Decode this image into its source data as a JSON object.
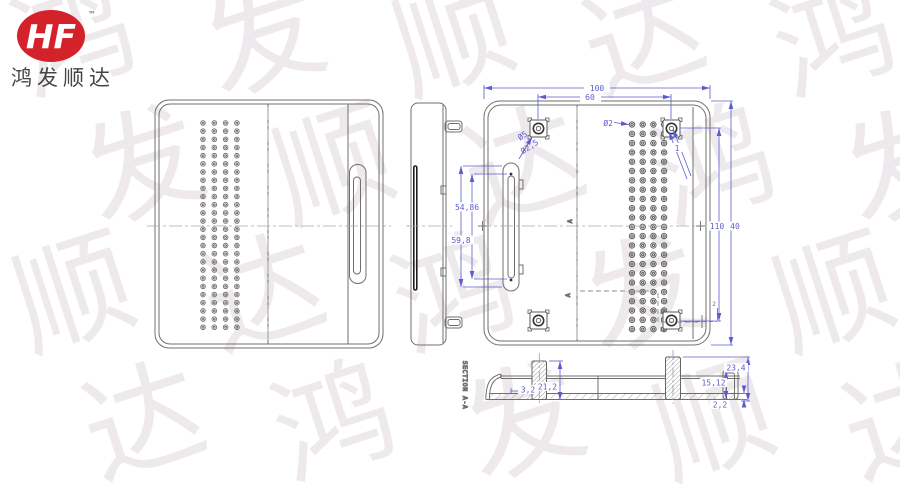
{
  "brand": {
    "logo_text": "HF",
    "trademark": "™",
    "company": "鸿发顺达"
  },
  "watermark": {
    "chars": [
      "鸿",
      "发",
      "顺",
      "达"
    ],
    "color": "#ece7eb"
  },
  "palette": {
    "line": "#6a6a6a",
    "dark": "#2a2a2a",
    "dim_blue": "#5c5ccf",
    "centerline": "#a0a0a0",
    "logo_red": "#d4222a",
    "company_text": "#454545"
  },
  "dims": {
    "top_width": "100",
    "boss_spacing": "60",
    "vent_hole_dia": "Ø2",
    "boss_od": "Ø5",
    "boss_id": "Ø2,5",
    "corner_note": "1",
    "slot_hole_pitch": "54,86",
    "slot_length": "59,8",
    "boss_v_spacing": "110",
    "height_note": "40",
    "edge_offset": "2",
    "sec_step": "3,2",
    "sec_boss_height": "21,2",
    "sec_total_height": "23,4",
    "sec_wall_height": "15,12",
    "sec_base_thickness": "2,2",
    "section_label": "SECTION A-A",
    "section_mark": "A"
  },
  "features": {
    "front_grid": {
      "x": 203,
      "y": 123,
      "cols": 4,
      "rows": 26,
      "dx": 11.3,
      "dy": 8.17,
      "r_outer": 2.3,
      "r_inner": 0.9
    },
    "back_grid": {
      "x": 632,
      "y": 124.5,
      "cols": 4,
      "rows": 23,
      "dx": 10.7,
      "dy": 9.3,
      "r_outer": 2.7,
      "r_inner": 1.1
    },
    "bosses": [
      [
        538.5,
        128.5
      ],
      [
        671.5,
        128.5
      ],
      [
        538.5,
        320.5
      ],
      [
        671.5,
        320.5
      ]
    ],
    "slot_dots": [
      [
        511,
        174
      ],
      [
        511,
        280
      ]
    ]
  }
}
